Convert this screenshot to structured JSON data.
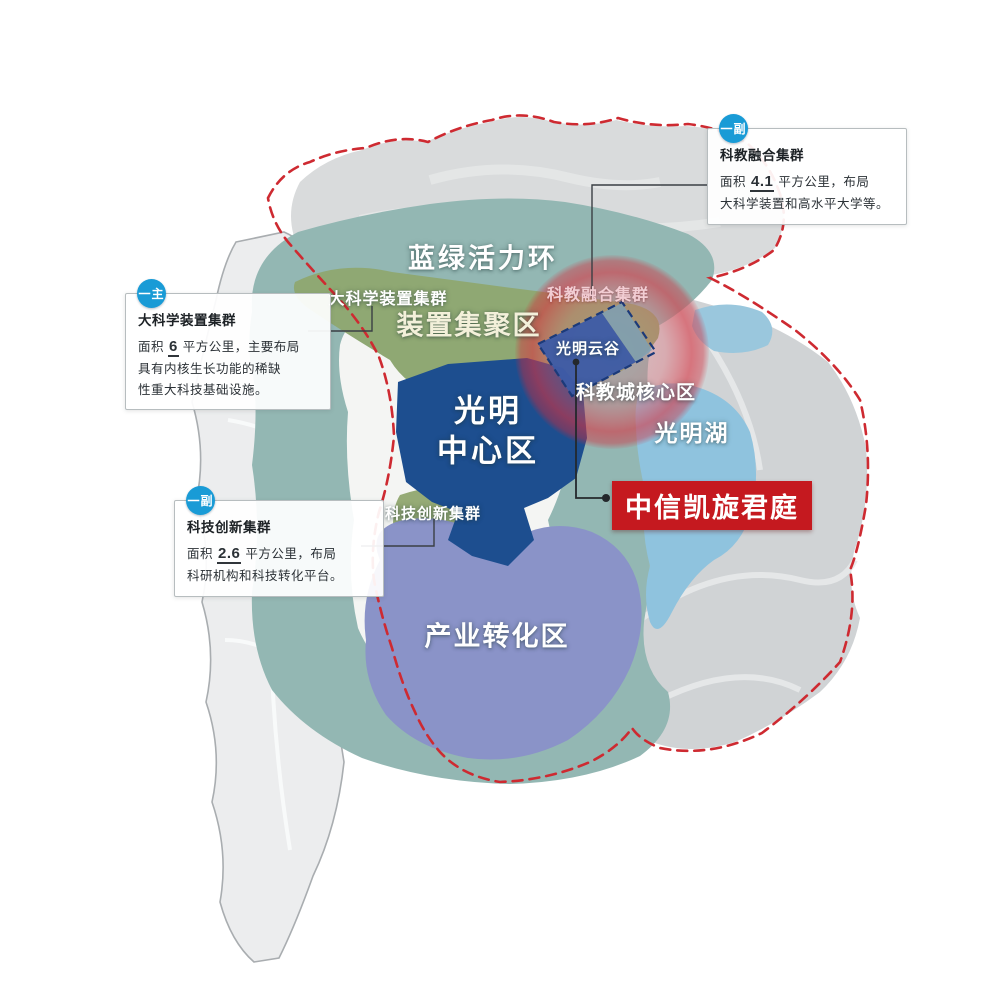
{
  "map_labels": {
    "ring": "蓝绿活力环",
    "device_cluster": "大科学装置集群",
    "device_zone": "装置集聚区",
    "edu_fusion_cluster": "科教融合集群",
    "cloud_valley": "光明云谷",
    "science_core": "科教城核心区",
    "center_line1": "光明",
    "center_line2": "中心区",
    "lake": "光明湖",
    "tech_cluster": "科技创新集群",
    "industry_zone": "产业转化区"
  },
  "property": {
    "name": "中信凯旋君庭"
  },
  "callouts": {
    "edu_fusion": {
      "badge": "一副",
      "title": "科教融合集群",
      "area_prefix": "面积 ",
      "area_value": "4.1",
      "area_suffix": " 平方公里，布局",
      "line2": "大科学装置和高水平大学等。"
    },
    "device": {
      "badge": "一主",
      "title": "大科学装置集群",
      "area_prefix": "面积 ",
      "area_value": "6",
      "area_suffix": " 平方公里，主要布局",
      "line2": "具有内核生长功能的稀缺",
      "line3": "性重大科技基础设施。"
    },
    "tech": {
      "badge": "一副",
      "title": "科技创新集群",
      "area_prefix": "面积 ",
      "area_value": "2.6",
      "area_suffix": " 平方公里，布局",
      "line2": "科研机构和科技转化平台。"
    }
  },
  "colors": {
    "badge_blue": "#199bd6",
    "property_red": "#c5191f",
    "boundary_red": "#ce2a31",
    "ring_teal": "#93b7b3",
    "center_blue": "#1d4e8f",
    "industry_purple": "#8a93c8",
    "lake_blue": "#8fc3de",
    "green_zone": "#8fa873",
    "valley_blue": "#3c5ba6"
  }
}
